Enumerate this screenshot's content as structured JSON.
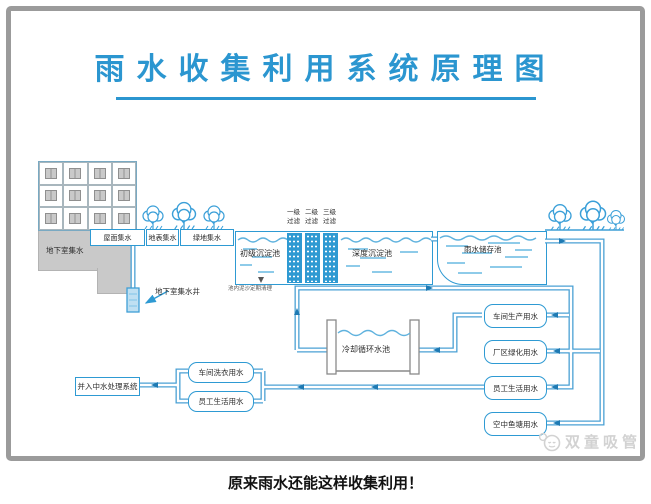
{
  "title": "雨水收集利用系统原理图",
  "caption": "原来雨水还能这样收集利用！",
  "watermark": "双童吸管",
  "colors": {
    "accent": "#2b96d0",
    "pipe": "#4aa0d4",
    "building_gray": "#c9c9c9",
    "watermark_gray": "#d2d2d2"
  },
  "icons": {
    "watermark_icon": "chat-face",
    "tree_icon": "tree",
    "flow_arrow": "triangle-arrow"
  },
  "collection": {
    "basement": "地下室集水",
    "roof": "屋面集水",
    "surface": "地表集水",
    "green": "绿地集水",
    "well": "地下室集水井"
  },
  "treatment": {
    "primary_tank": "初级沉淀池",
    "deep_tank": "深度沉淀池",
    "filters": [
      "一级过滤",
      "二级过滤",
      "三级过滤"
    ],
    "note": "池内泥沙定期清理",
    "storage": "雨水储存池",
    "cooling": "冷却循环水池"
  },
  "uses_right": [
    "车间生产用水",
    "厂区绿化用水",
    "员工生活用水",
    "空中鱼塘用水"
  ],
  "uses_left": [
    "车间洗衣用水",
    "员工生活用水"
  ],
  "discharge": "并入中水处理系统"
}
